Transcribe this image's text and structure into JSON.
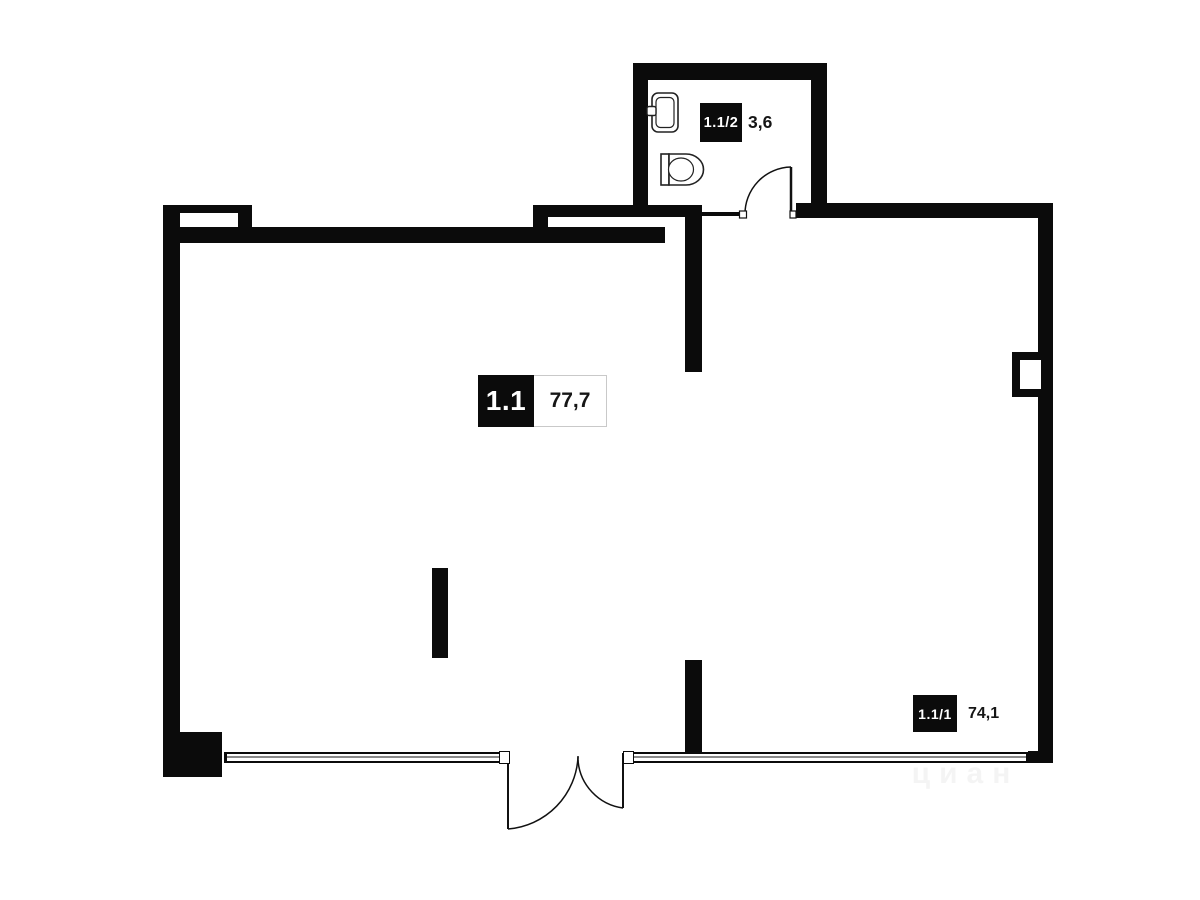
{
  "plan": {
    "main_unit": {
      "id": "1.1",
      "area": "77,7"
    },
    "rooms": [
      {
        "id": "1.1/2",
        "area": "3,6",
        "name": "bathroom"
      },
      {
        "id": "1.1/1",
        "area": "74,1",
        "name": "main-room"
      }
    ],
    "watermark": "циан"
  },
  "colors": {
    "wall": "#0b0b0b",
    "background": "#ffffff",
    "fixture_line": "#222222",
    "window_mid_line": "#8a8a8a",
    "area_box_border": "#c9c9c9"
  },
  "icons": {
    "sink": "sink-icon",
    "toilet": "toilet-icon",
    "bath_door": "door-arc-icon",
    "entry_door": "double-door-arc-icon"
  }
}
